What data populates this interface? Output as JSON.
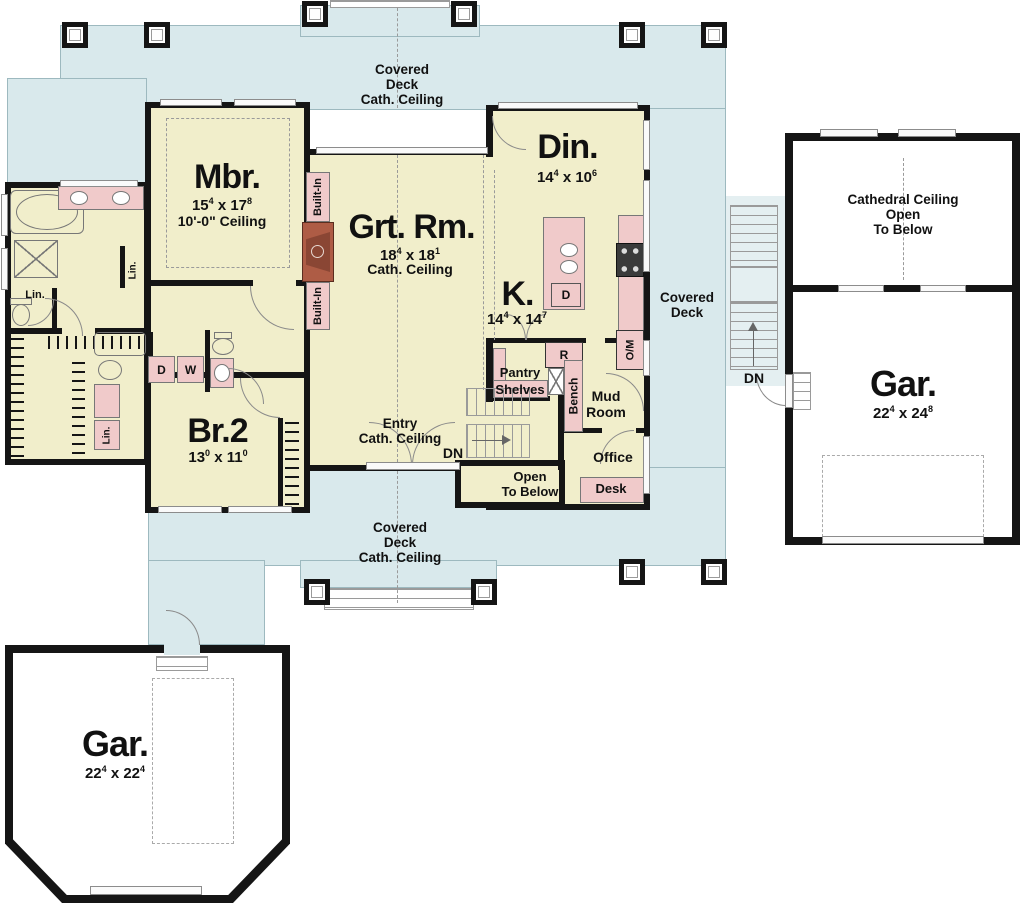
{
  "plan": {
    "deck_word1": "Covered",
    "deck_word2": "Deck",
    "cath": "Cath. Ceiling",
    "entry": "Entry",
    "dn": "DN",
    "open1": "Open",
    "open2": "To Below",
    "pantry": "Pantry",
    "shelves": "Shelves",
    "bench": "Bench",
    "mud1": "Mud",
    "mud2": "Room",
    "office": "Office",
    "desk": "Desk",
    "r": "R",
    "d": "D",
    "w": "W",
    "om": "O/M",
    "lin": "Lin.",
    "built_in": "Built-In",
    "x": "x",
    "cathedral1": "Cathedral Ceiling",
    "cathedral2": "Open",
    "cathedral3": "To Below"
  },
  "rooms": {
    "mbr": {
      "name": "Mbr.",
      "a": "15",
      "as": "4",
      "b": "17",
      "bs": "8",
      "ceiling": "10'-0\" Ceiling"
    },
    "grt": {
      "name": "Grt. Rm.",
      "a": "18",
      "as": "4",
      "b": "18",
      "bs": "1",
      "ceiling": "Cath. Ceiling"
    },
    "din": {
      "name": "Din.",
      "a": "14",
      "as": "4",
      "b": "10",
      "bs": "6"
    },
    "k": {
      "name": "K.",
      "a": "14",
      "as": "4",
      "b": "14",
      "bs": "7"
    },
    "br2": {
      "name": "Br.2",
      "a": "13",
      "as": "0",
      "b": "11",
      "bs": "0"
    },
    "gar_right": {
      "name": "Gar.",
      "a": "22",
      "as": "4",
      "b": "24",
      "bs": "8"
    },
    "gar_left": {
      "name": "Gar.",
      "a": "22",
      "as": "4",
      "b": "22",
      "bs": "4"
    }
  },
  "colors": {
    "deck": "#d9e9ec",
    "room": "#f1eecb",
    "fixture": "#f0caca",
    "fireplace": "#ae5c45",
    "wall": "#151515"
  }
}
